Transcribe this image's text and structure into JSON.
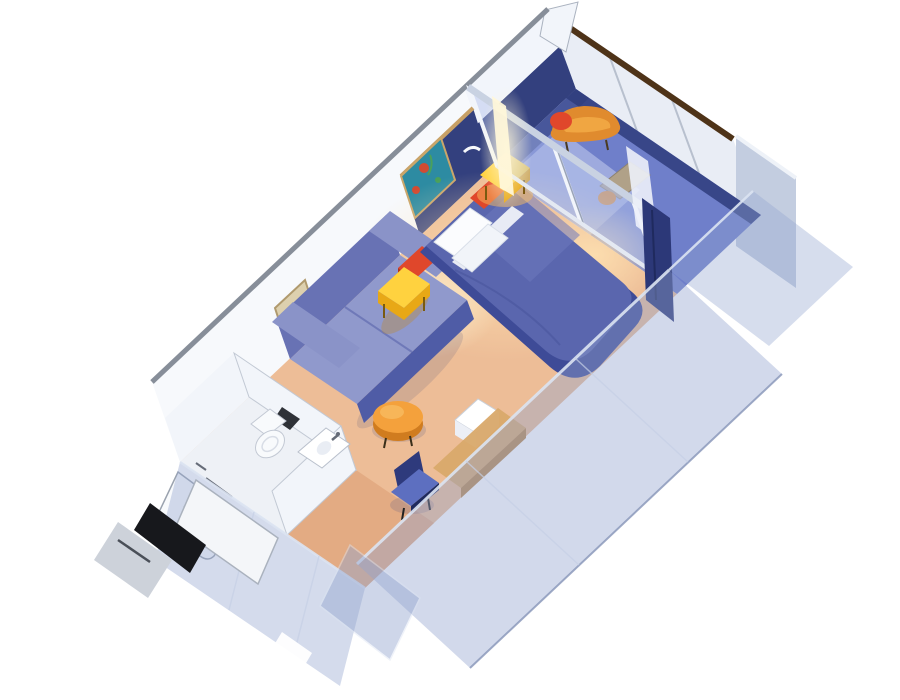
{
  "meta": {
    "title": "Balcony stateroom 3D cutaway rendering",
    "view": "isometric cutaway seen from above, cabin runs diagonally from lower-left entry to upper-right balcony",
    "background": "#ffffff"
  },
  "scene": {
    "objects": [
      "balcony-deck",
      "balcony-end-wall",
      "balcony-railing-cap",
      "balcony-partition-wall",
      "balcony-lounge-chair",
      "balcony-chair-cushion",
      "balcony-side-table",
      "balcony-stool",
      "sliding-glass-door",
      "door-divider",
      "door-light-glow",
      "white-sheer-curtain",
      "navy-curtain",
      "back-wall",
      "wall-top-trim",
      "headboard-accent-wall",
      "headboard-trim",
      "reading-lamp",
      "reef-artwork",
      "framed-artwork",
      "queen-bed",
      "bed-pillows",
      "red-accent-cushion-near",
      "red-accent-cushion-far",
      "nightstand-near",
      "nightstand-far",
      "sofa",
      "round-ottoman",
      "mini-fridge-box",
      "vanity-desk",
      "vanity-chair",
      "carpet",
      "entry-corridor",
      "bathroom-floor",
      "shower-stall",
      "shower-rod",
      "toilet",
      "sink-counter",
      "towel-bar",
      "cutaway-near-wall",
      "cutaway-entry-wall",
      "wardrobe-panel",
      "entry-door",
      "door-gap",
      "corridor-step"
    ]
  },
  "colors": {
    "background": "#ffffff",
    "wall_white": "#f7f9fc",
    "wall_trim_gray": "#878e99",
    "balcony_back_upper": "#f2f5fb",
    "headboard_panel_navy": "#33407e",
    "headboard_trim_tan": "#c7a066",
    "lamp_white": "#f6f8fb",
    "carpet": "#edbd97",
    "carpet_corridor": "#e3ab83",
    "glow_warm": "#ffe3b3",
    "glow_lamp": "#fff7d9",
    "balcony_floor": "#6f7fca",
    "balcony_floor_edge": "#2f3c7c",
    "balcony_floor_light": "#cdd5f2",
    "balcony_end_wall": "#e9edf5",
    "balcony_mullion": "#b8c0ce",
    "balcony_cap_brown": "#4e3318",
    "partition_panel": "#c3cde0",
    "partition_edge": "#eef2f8",
    "glass_tint": "#aebdea",
    "glass_frame": "#f2f5fb",
    "glass_frame_shadow": "#9aa4b8",
    "door_header": "#c9d2e2",
    "door_sill": "#e4e9f2",
    "curtain_navy": "#2c3878",
    "curtain_white": "#edf1f9",
    "bedspread_top": "#5a66ae",
    "bedspread_side": "#3e4b97",
    "bedspread_sheen": "#6d79bd",
    "bedspread_fold": "#4c58a0",
    "pillow_white": "#fbfcfe",
    "pillow_shade": "#f1f4f9",
    "sheet_white": "#f6f8fc",
    "cushion_red": "#e0472b",
    "cushion_red_dark": "#b23317",
    "nightstand_yellow": "#ffd23f",
    "nightstand_side": "#e8a816",
    "nightstand_leg": "#7a5a10",
    "sofa_back": "#6872b4",
    "sofa_seat": "#9099cc",
    "sofa_front": "#4f5ca6",
    "sofa_arm": "#8a93c8",
    "sofa_seam": "#6f79b8",
    "ottoman_orange": "#f4a13c",
    "ottoman_side": "#d07c1f",
    "ottoman_highlight": "#f8bb60",
    "minibar_top": "#ffffff",
    "minibar_front": "#dde3ee",
    "minibar_side": "#eceff6",
    "desk_wood": "#d9a96a",
    "desk_edge": "#b9884e",
    "chair_seat_blue": "#5d6fc0",
    "chair_back_navy": "#2e3a7c",
    "chair_seat_dark": "#1e2a5e",
    "bath_floor": "#eef1f6",
    "bath_wall": "#f2f5fa",
    "fixture_white": "#f8fafc",
    "fixture_outline": "#9aa2ae",
    "fixture_dark": "#1a1d22",
    "fixture_metal": "#666c78",
    "cutaway_glass": "#93a5cf",
    "cutaway_edge": "#dce4f2",
    "cutaway_outer_edge": "#8795b8",
    "cutaway_seam": "#c6d0e6",
    "door_slab": "#f4f6f9",
    "door_gap_dark": "#17181c",
    "step_gray": "#cdd2da",
    "step_line": "#4a4f58",
    "balcony_chair_orange": "#e08b2e",
    "balcony_chair_highlight": "#f2a845",
    "balcony_chair_leg": "#4a3a20",
    "balcony_table_tan": "#b0a188",
    "artwork_reef_bg": "#2d8ba2",
    "artwork_reef_red": "#d14b32",
    "artwork_reef_green": "#4aa05a",
    "artwork_frame_gold": "#caa66a",
    "artwork_tan_bg": "#ddd0ae",
    "artwork_tan_frame": "#b09a6e",
    "artwork_tan_dark": "#5c4a2e",
    "artwork_tan_light": "#ffffff",
    "shadow": "#5a5a82",
    "warm_shadow": "#b8893f",
    "apex_fin": "#f2f5fa",
    "apex_edge": "#aab2bf"
  }
}
